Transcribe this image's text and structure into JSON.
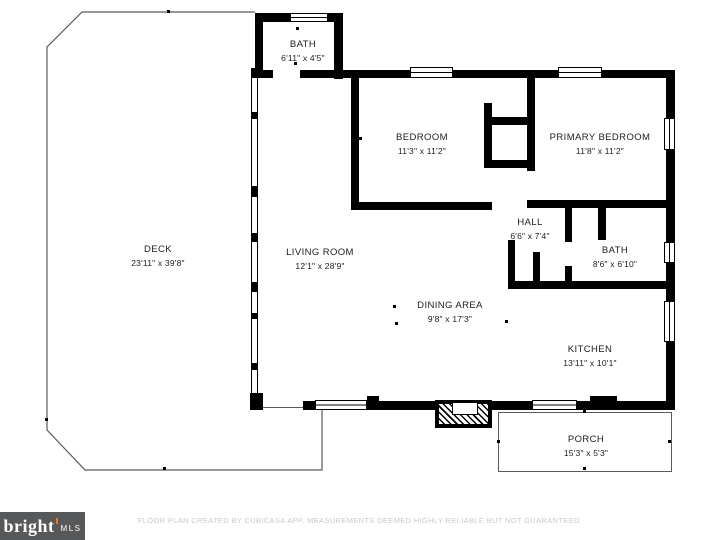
{
  "footer": {
    "logo_primary": "bright",
    "logo_secondary": "MLS",
    "disclaimer": "FLOOR PLAN CREATED BY CUBICASA APP. MEASUREMENTS DEEMED HIGHLY RELIABLE BUT NOT GUARANTEED."
  },
  "colors": {
    "wall": "#000000",
    "deck_outline": "#5a5a5a",
    "logo_background": "#57585a",
    "logo_accent": "#e87722",
    "disclaimer_text": "#c9c9c9"
  },
  "rooms": {
    "bath_top": {
      "name": "BATH",
      "dims": "6'11\" x 4'5\""
    },
    "bedroom": {
      "name": "BEDROOM",
      "dims": "11'3\" x 11'2\""
    },
    "primary_bedroom": {
      "name": "PRIMARY BEDROOM",
      "dims": "11'8\" x 11'2\""
    },
    "deck": {
      "name": "DECK",
      "dims": "23'11\" x 39'8\""
    },
    "living_room": {
      "name": "LIVING ROOM",
      "dims": "12'1\" x 28'9\""
    },
    "hall": {
      "name": "HALL",
      "dims": "6'6\" x 7'4\""
    },
    "bath": {
      "name": "BATH",
      "dims": "8'6\" x 6'10\""
    },
    "dining_area": {
      "name": "DINING AREA",
      "dims": "9'8\" x 17'3\""
    },
    "kitchen": {
      "name": "KITCHEN",
      "dims": "13'11\" x 10'1\""
    },
    "porch": {
      "name": "PORCH",
      "dims": "15'3\" x 5'3\""
    }
  }
}
